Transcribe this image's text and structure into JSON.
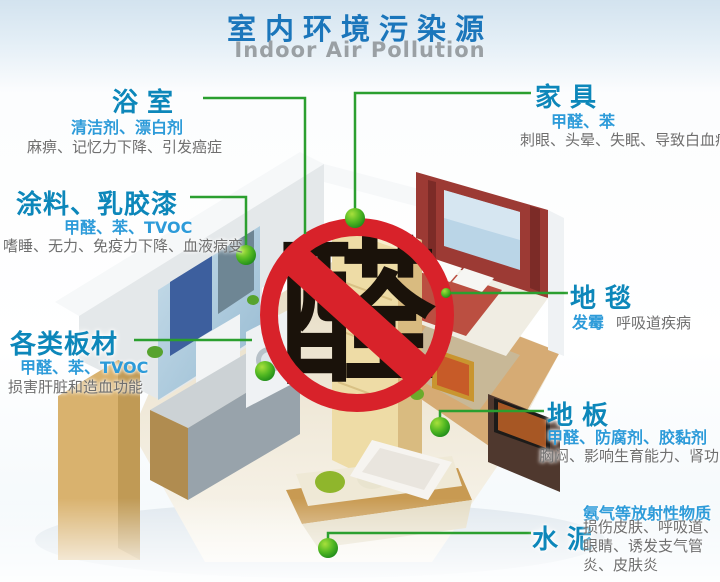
{
  "header": {
    "title": "室内环境污染源",
    "subtitle": "Indoor Air Pollution"
  },
  "sign": {
    "character": "醛"
  },
  "sources": {
    "bathroom": {
      "name": "浴室",
      "pollutants": "清洁剂、漂白剂",
      "effects": "麻痹、记忆力下降、引发癌症"
    },
    "furniture": {
      "name": "家具",
      "pollutants": "甲醛、苯",
      "effects": "刺眼、头晕、失眠、导致白血病"
    },
    "paint": {
      "name": "涂料、乳胶漆",
      "pollutants": "甲醛、苯、TVOC",
      "effects": "嗜睡、无力、免疫力下降、血液病变"
    },
    "boards": {
      "name": "各类板材",
      "pollutants": "甲醛、苯、TVOC",
      "effects": "损害肝脏和造血功能"
    },
    "carpet": {
      "name": "地毯",
      "pollutants": "发霉",
      "effects": "呼吸道疾病"
    },
    "floor": {
      "name": "地板",
      "pollutants": "甲醛、防腐剂、胶黏剂",
      "effects": "胸闷、影响生育能力、肾功能"
    },
    "cement": {
      "name": "水泥",
      "pollutants": "氨气等放射性物质",
      "effects": "损伤皮肤、呼吸道、眼睛、诱发支气管炎、皮肤炎"
    }
  },
  "colors": {
    "title_blue": "#1b76bb",
    "subtitle_gray": "#9aa0a4",
    "heading_teal": "#0d87ba",
    "pollutant_blue": "#2d9bd9",
    "effect_gray": "#6f6f6f",
    "connector_green": "#2b9f2f",
    "sign_red": "#d8222a"
  }
}
